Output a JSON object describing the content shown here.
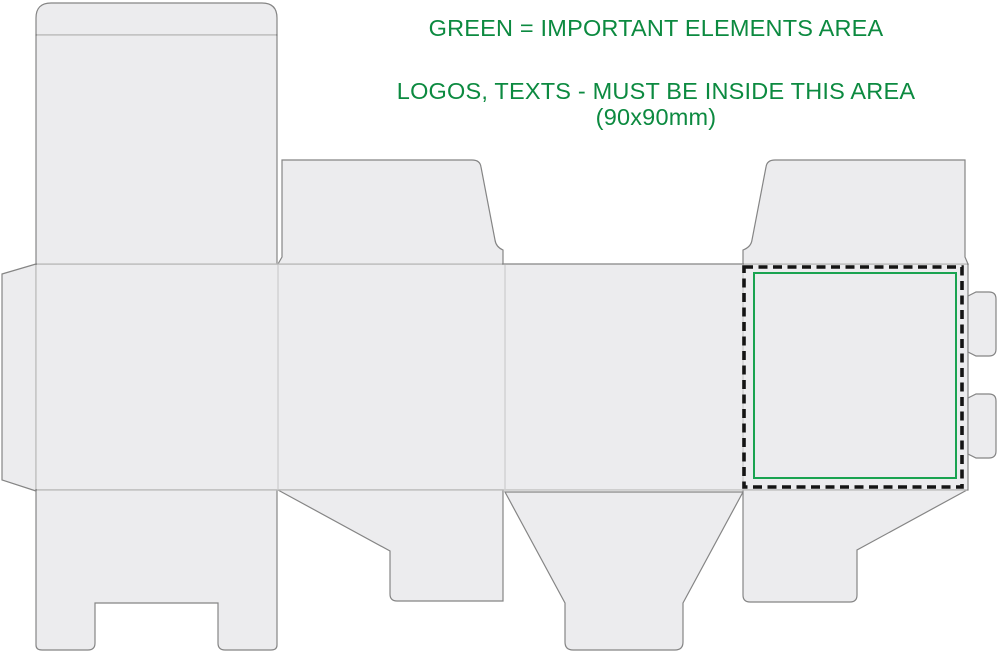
{
  "annotation": {
    "line1": "GREEN = IMPORTANT ELEMENTS AREA",
    "line2": "LOGOS, TEXTS - MUST BE INSIDE THIS AREA",
    "line3": "(90x90mm)",
    "area_dimensions": "90x90mm"
  },
  "colors": {
    "background": "#ffffff",
    "panel_fill": "#ececee",
    "cut_line": "#858585",
    "fold_line": "#c9c9c9",
    "dash_black": "#141414",
    "area_green": "#19a350",
    "text_green": "#0c8a40"
  }
}
